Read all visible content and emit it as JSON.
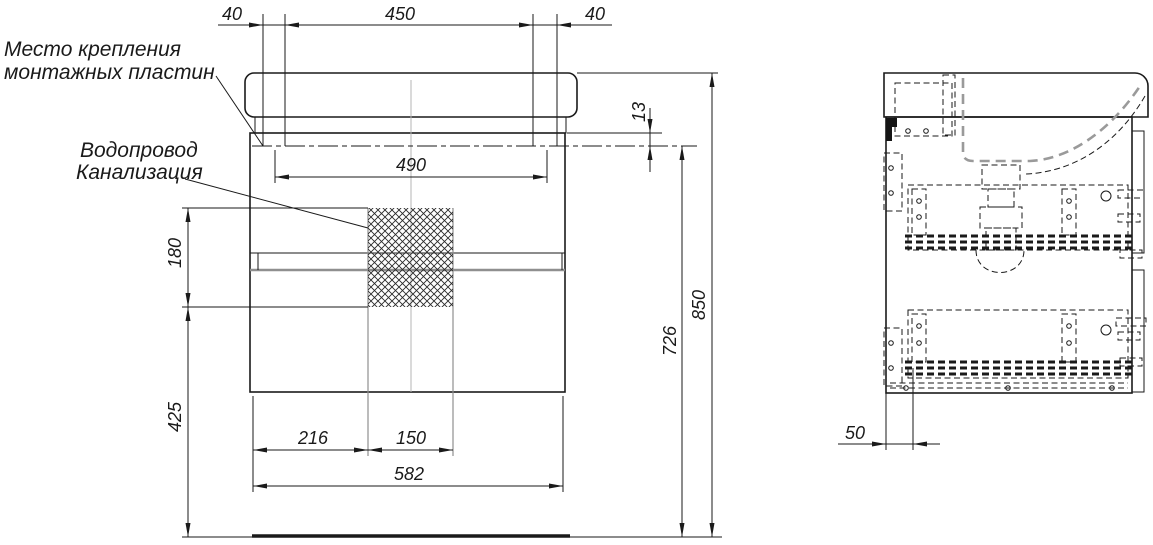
{
  "drawing": {
    "type": "vanity-cabinet-installation-drawing",
    "views": [
      "front-view",
      "side-view"
    ]
  },
  "annotations": {
    "mounting_plates": {
      "line1": "Место крепления",
      "line2": "монтажных пластин"
    },
    "plumbing": {
      "line1": "Водопровод",
      "line2": "Канализация"
    }
  },
  "dimensions": {
    "top_left_offset": "40",
    "top_plate_span": "450",
    "top_right_offset": "40",
    "plate_centers_span": "490",
    "rim_to_mount_line": "13",
    "service_zone_height": "180",
    "service_zone_to_floor": "425",
    "bottom_left_segment": "216",
    "bottom_mid_segment": "150",
    "cabinet_width": "582",
    "mount_line_height": "726",
    "overall_height": "850",
    "side_back_offset": "50"
  },
  "colors": {
    "line": "#1a1a1a",
    "secondary_line": "#8f8f8f",
    "hidden_line_gray": "#9a9a9a",
    "background": "#ffffff"
  }
}
